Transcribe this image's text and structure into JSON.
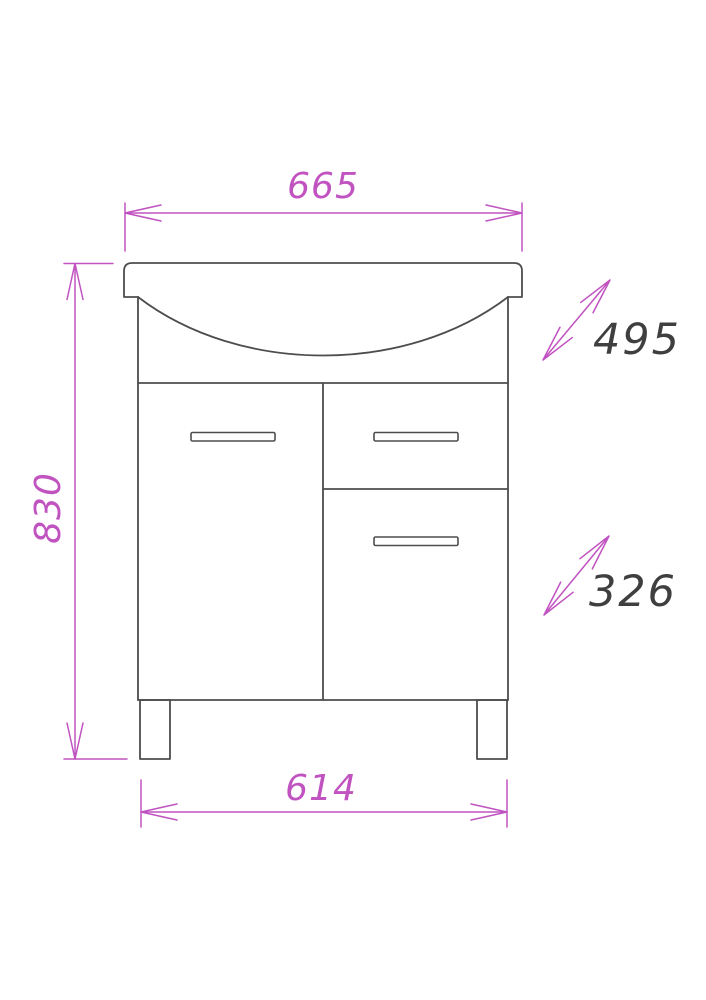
{
  "drawing": {
    "labels": {
      "top_width": "665",
      "height": "830",
      "bottom_width": "614",
      "upper_depth": "495",
      "lower_depth": "326"
    },
    "colors": {
      "dimension": "#c153c1",
      "outline": "#4d4d4d",
      "depth-text": "#3f3f3f",
      "background": "#ffffff"
    }
  }
}
